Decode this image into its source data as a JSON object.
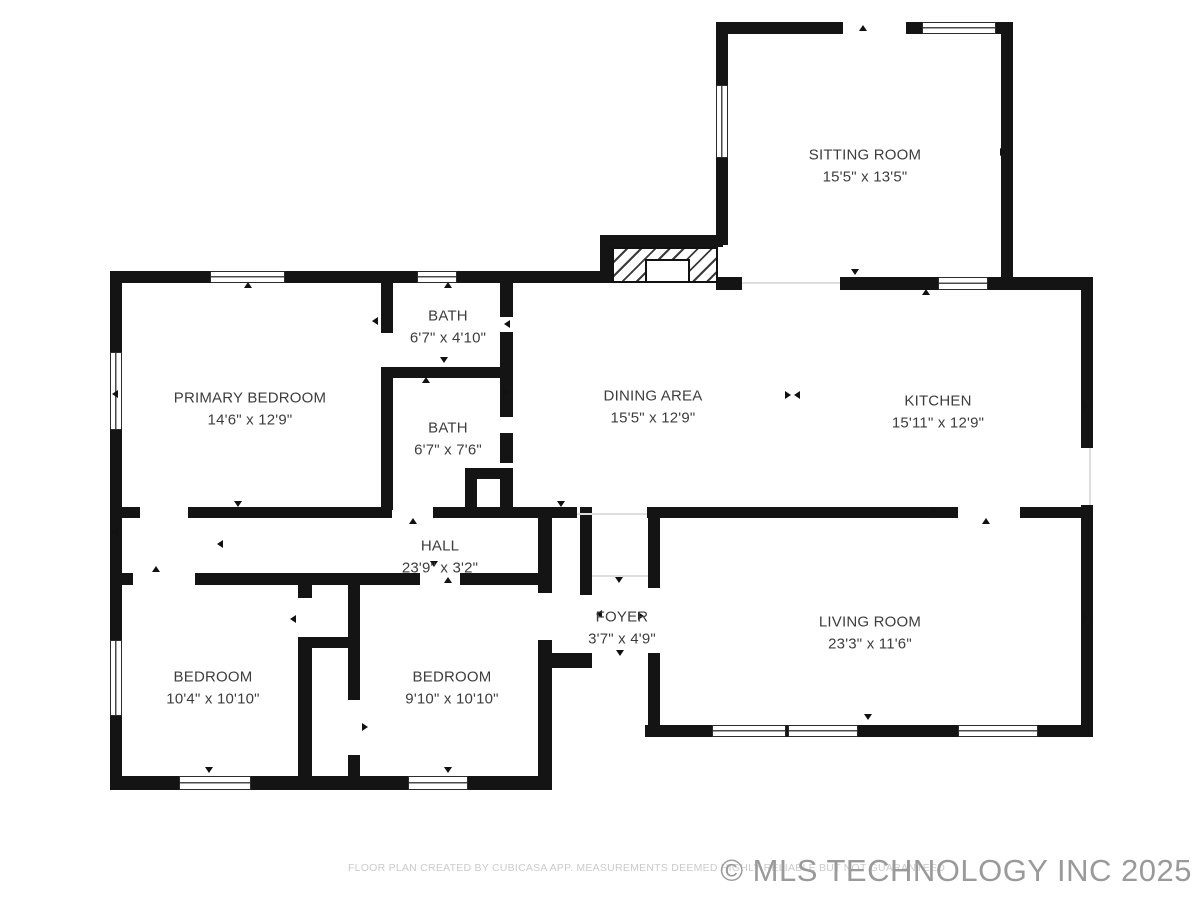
{
  "rooms": [
    {
      "id": "sitting-room",
      "name": "SITTING ROOM",
      "dims": "15'5\" x 13'5\""
    },
    {
      "id": "primary-bedroom",
      "name": "PRIMARY BEDROOM",
      "dims": "14'6\" x 12'9\""
    },
    {
      "id": "bath-upper",
      "name": "BATH",
      "dims": "6'7\" x 4'10\""
    },
    {
      "id": "bath-lower",
      "name": "BATH",
      "dims": "6'7\" x 7'6\""
    },
    {
      "id": "dining-area",
      "name": "DINING AREA",
      "dims": "15'5\" x 12'9\""
    },
    {
      "id": "kitchen",
      "name": "KITCHEN",
      "dims": "15'11\" x 12'9\""
    },
    {
      "id": "hall",
      "name": "HALL",
      "dims": "23'9\" x 3'2\""
    },
    {
      "id": "foyer",
      "name": "FOYER",
      "dims": "3'7\" x 4'9\""
    },
    {
      "id": "living-room",
      "name": "LIVING ROOM",
      "dims": "23'3\" x 11'6\""
    },
    {
      "id": "bedroom-left",
      "name": "BEDROOM",
      "dims": "10'4\" x 10'10\""
    },
    {
      "id": "bedroom-middle",
      "name": "BEDROOM",
      "dims": "9'10\" x 10'10\""
    }
  ],
  "footer": {
    "disclaimer": "FLOOR PLAN CREATED BY CUBICASA APP. MEASUREMENTS DEEMED HIGHLY RELIABLE BUT NOT GUARANTEED",
    "copyright": "© MLS TECHNOLOGY INC 2025"
  },
  "colors": {
    "wall": "#141414",
    "label_text": "#3d3d3d",
    "disclaimer_text": "#cbcbcb",
    "copyright_text": "#9a9a9a"
  }
}
